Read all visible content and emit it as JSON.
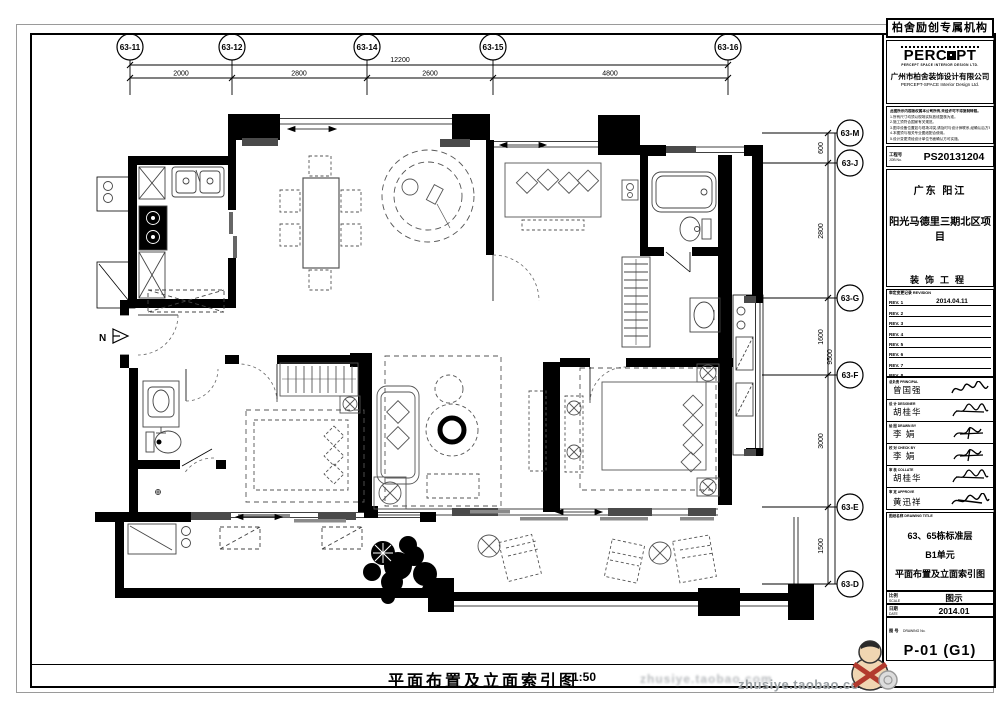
{
  "sheet": {
    "bottom_title": "平面布置及立面索引图",
    "bottom_scale": "1:50",
    "watermark": "zhusiye.taobao.com",
    "north_label": "N"
  },
  "grid": {
    "top": [
      "63-11",
      "63-12",
      "63-14",
      "63-15",
      "63-16"
    ],
    "top_dims": {
      "overall": "12200",
      "segments": [
        "2000",
        "2800",
        "2600",
        "4800"
      ]
    },
    "right": [
      "63-M",
      "63-J",
      "63-G",
      "63-F",
      "63-E",
      "63-D"
    ],
    "right_dims": {
      "overall": "9500",
      "segments": [
        "600",
        "2800",
        "1600",
        "3000",
        "1500"
      ]
    }
  },
  "titleblock": {
    "agency": "柏舍励创专属机构",
    "logo_left": "PERC",
    "logo_right": "PT",
    "logo_tagline": "PERCEPT SPACE INTERIOR DESIGN LTD.",
    "company_cn": "广州市柏舍装饰设计有限公司",
    "company_en": "PERCEPT-SPACE Interior Design Ltd.",
    "notes": [
      "此图所示内容版权属本公司所有,未经许可不得复制转载。",
      "1.所有尺寸均须以现场实际放线复核为准。",
      "2.施工须符合国家有关规范。",
      "3.图中设备位置如与现场冲突,请及时与设计师联系,经确认后方可施工。",
      "4.本图须与相关专业图纸配合使用。",
      "5.设计变更须经设计单位书面确认方可实施。"
    ],
    "job_label_cn": "工程号",
    "job_label_en": "JOB No.",
    "job_no": "PS20131204",
    "location": "广东 阳江",
    "project": "阳光马德里三期北区项目",
    "project_type": "装饰工程",
    "revision_header": "审定变更记录 REVISION",
    "revisions": [
      {
        "label": "REV. 1",
        "date": "2014.04.11"
      },
      {
        "label": "REV. 2",
        "date": ""
      },
      {
        "label": "REV. 3",
        "date": ""
      },
      {
        "label": "REV. 4",
        "date": ""
      },
      {
        "label": "REV. 5",
        "date": ""
      },
      {
        "label": "REV. 6",
        "date": ""
      },
      {
        "label": "REV. 7",
        "date": ""
      },
      {
        "label": "REV. 8",
        "date": ""
      }
    ],
    "signatures": [
      {
        "cn": "总负责",
        "en": "PRINCIPAL",
        "name": "曾国强"
      },
      {
        "cn": "设 计",
        "en": "DESIGNER",
        "name": "胡桂华"
      },
      {
        "cn": "绘 图",
        "en": "DRAWN BY",
        "name": "李 娟"
      },
      {
        "cn": "校 对",
        "en": "CHECK BY",
        "name": "李 娟"
      },
      {
        "cn": "审 核",
        "en": "COLLATE",
        "name": "胡桂华"
      },
      {
        "cn": "审 定",
        "en": "APPROVE",
        "name": "黄迅祥"
      }
    ],
    "drawing_title_label": "图纸名称 DRAWING TITLE",
    "drawing_title_lines": [
      "63、65栋标准层",
      "B1单元",
      "平面布置及立面索引图"
    ],
    "scale_label_cn": "比例",
    "scale_label_en": "SCALE",
    "scale_value": "图示",
    "date_label_cn": "日期",
    "date_label_en": "DATE",
    "date_value": "2014.01",
    "dwg_label_cn": "图  号",
    "dwg_label_en": "DRAWING No.",
    "dwg_no": "P-01 (G1)"
  }
}
